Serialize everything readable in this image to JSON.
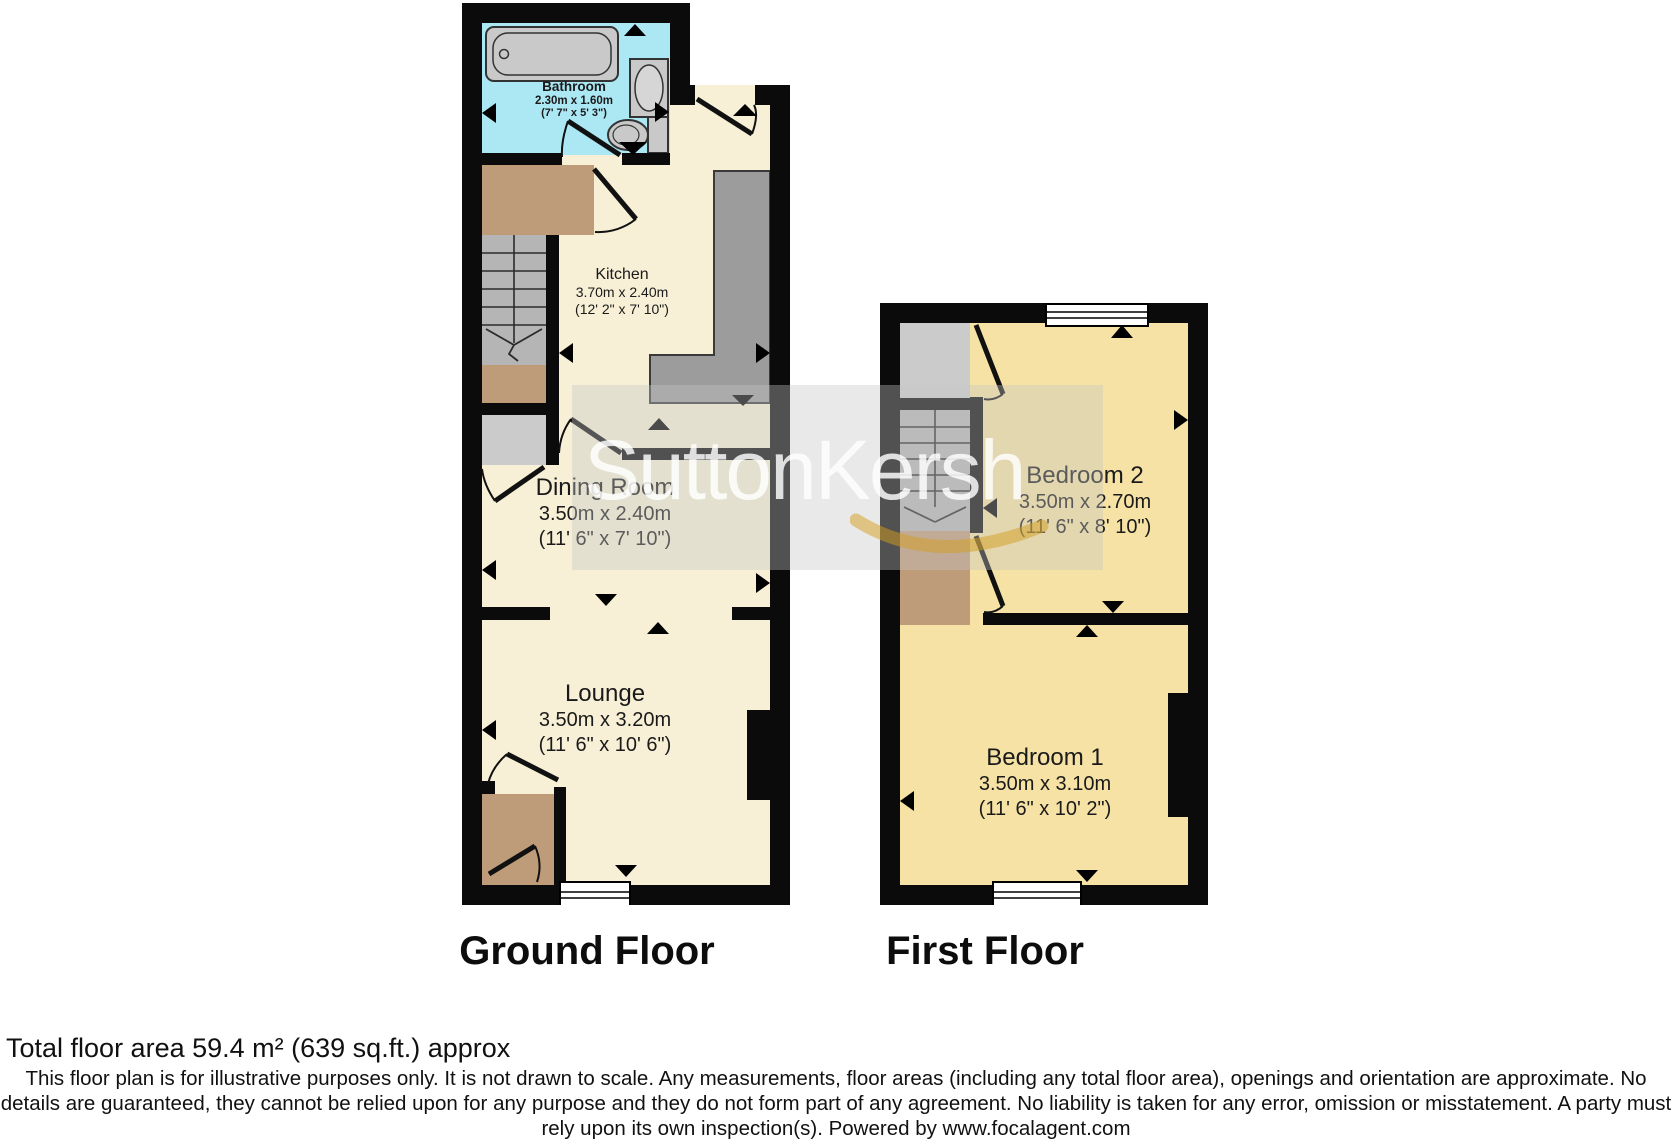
{
  "watermark": {
    "text": "SuttonKersh"
  },
  "floors": {
    "ground": {
      "title": "Ground Floor",
      "rooms": {
        "bathroom": {
          "name": "Bathroom",
          "metric": "2.30m x 1.60m",
          "imperial": "(7' 7\" x 5' 3\")"
        },
        "kitchen": {
          "name": "Kitchen",
          "metric": "3.70m x 2.40m",
          "imperial": "(12' 2\" x 7' 10\")"
        },
        "dining": {
          "name": "Dining Room",
          "metric": "3.50m x 2.40m",
          "imperial": "(11' 6\" x 7' 10\")"
        },
        "lounge": {
          "name": "Lounge",
          "metric": "3.50m x 3.20m",
          "imperial": "(11' 6\" x 10' 6\")"
        }
      }
    },
    "first": {
      "title": "First Floor",
      "rooms": {
        "bedroom2": {
          "name": "Bedroom 2",
          "metric": "3.50m x 2.70m",
          "imperial": "(11' 6\" x 8' 10\")"
        },
        "bedroom1": {
          "name": "Bedroom 1",
          "metric": "3.50m x 3.10m",
          "imperial": "(11' 6\" x 10' 2\")"
        }
      }
    }
  },
  "footer": {
    "total_area": "Total floor area 59.4 m² (639 sq.ft.) approx",
    "disclaimer": "This floor plan is for illustrative purposes only. It is not drawn to scale. Any measurements, floor areas (including any total floor area), openings and orientation are approximate. No details are guaranteed, they cannot be relied upon for any purpose and they do not form part of any agreement. No liability is taken for any error, omission or misstatement. A party must rely upon its own inspection(s). Powered by www.focalagent.com"
  },
  "colors": {
    "wall": "#0b0b0b",
    "ground_room": "#f7f0d6",
    "bathroom": "#ace7f4",
    "bedroom": "#f6e2a4",
    "hall_brown": "#bf9c79",
    "stairs_gray": "#b5b5b5",
    "closet_gray": "#cbcbcb",
    "counter_gray": "#9c9c9c",
    "watermark_gold": "#d49e1e"
  }
}
